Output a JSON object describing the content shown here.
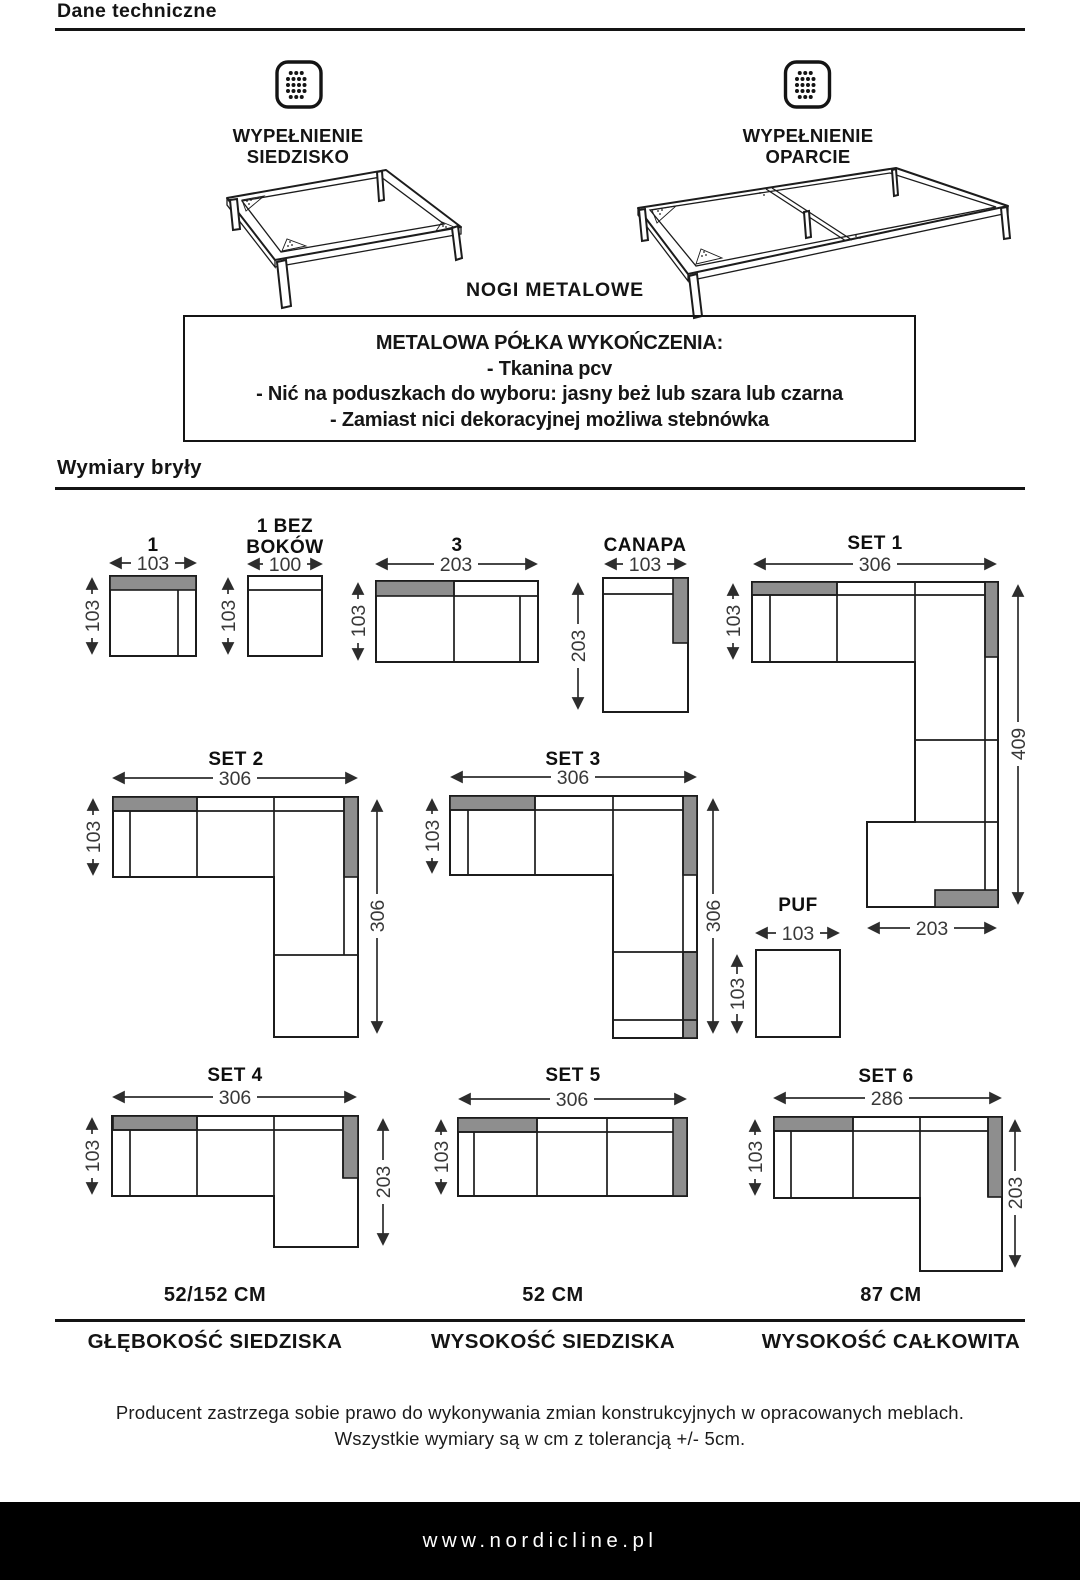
{
  "header": {
    "title": "Dane techniczne"
  },
  "materials": {
    "seat_icon": "dotted-square-icon",
    "back_icon": "dotted-square-icon",
    "seat_label_line1": "WYPEŁNIENIE",
    "seat_label_line2": "SIEDZISKO",
    "back_label_line1": "WYPEŁNIENIE",
    "back_label_line2": "OPARCIE",
    "legs_label": "NOGI METALOWE"
  },
  "finish_box": {
    "title": "METALOWA PÓŁKA WYKOŃCZENIA:",
    "item1": "- Tkanina pcv",
    "item2": "- Nić na poduszkach do wyboru: jasny beż lub szara lub czarna",
    "item3": "- Zamiast nici dekoracyjnej możliwa stebnówka"
  },
  "section": {
    "title": "Wymiary bryły"
  },
  "dims": {
    "d1": {
      "title": "1",
      "w": "103",
      "h": "103"
    },
    "d1bb": {
      "title_line1": "1 BEZ",
      "title_line2": "BOKÓW",
      "w": "100",
      "h": "103"
    },
    "d3": {
      "title": "3",
      "w": "203",
      "h": "103"
    },
    "canapa": {
      "title": "CANAPA",
      "w": "103",
      "h": "203"
    },
    "set1": {
      "title": "SET 1",
      "w": "306",
      "h_left": "103",
      "h_right": "409",
      "w_bottom": "203"
    },
    "set2": {
      "title": "SET 2",
      "w": "306",
      "h_left": "103",
      "h_right": "306"
    },
    "set3": {
      "title": "SET 3",
      "w": "306",
      "h_left": "103",
      "h_right": "306",
      "h_bottom": "103"
    },
    "puf": {
      "title": "PUF",
      "w": "103"
    },
    "set4": {
      "title": "SET 4",
      "w": "306",
      "h_left": "103",
      "h_right": "203"
    },
    "set5": {
      "title": "SET 5",
      "w": "306",
      "h_left": "103"
    },
    "set6": {
      "title": "SET 6",
      "w": "286",
      "h_left": "103",
      "h_right": "203"
    }
  },
  "specs": [
    {
      "value": "52/152 CM",
      "label": "GŁĘBOKOŚĆ SIEDZISKA"
    },
    {
      "value": "52 CM",
      "label": "WYSOKOŚĆ SIEDZISKA"
    },
    {
      "value": "87 CM",
      "label": "WYSOKOŚĆ CAŁKOWITA"
    }
  ],
  "disclaimer": {
    "line1": "Producent zastrzega sobie prawo do wykonywania zmian konstrukcyjnych w opracowanych meblach.",
    "line2": "Wszystkie wymiary są w cm z tolerancją +/- 5cm."
  },
  "footer": {
    "url": "www.nordicline.pl"
  },
  "colors": {
    "accent_gray": "#8e8e8e",
    "line": "#1c1c1c",
    "footer_bg": "#000000"
  }
}
